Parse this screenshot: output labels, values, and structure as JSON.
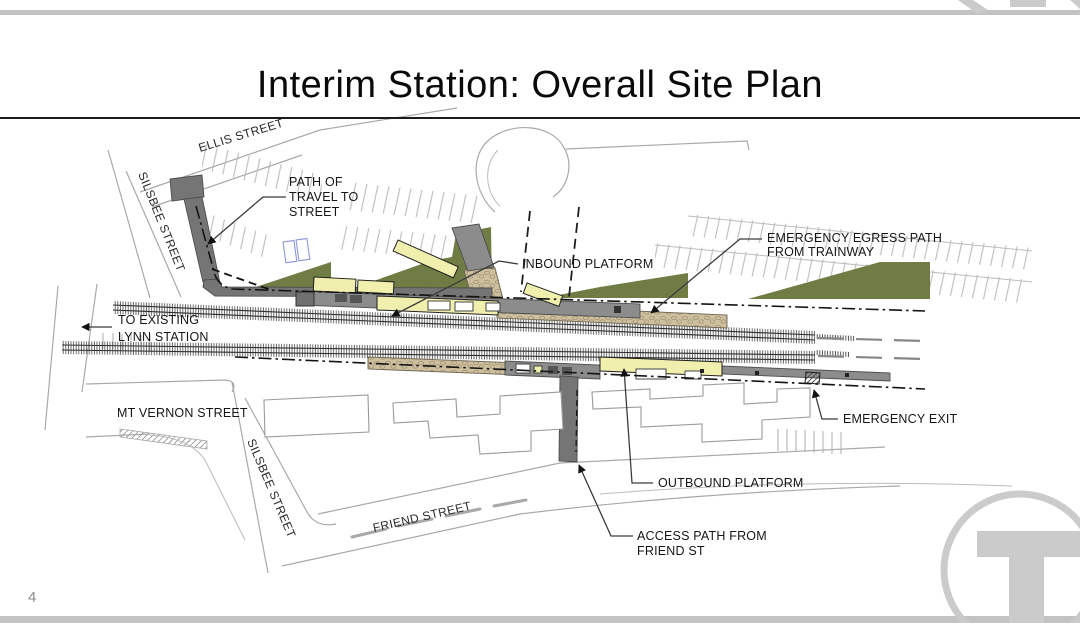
{
  "slide": {
    "title": "Interim Station: Overall Site Plan",
    "page_number": "4"
  },
  "colors": {
    "platform_yellow": "#f1efad",
    "landscape_green": "#6f7d44",
    "path_gray": "#8c8c8c",
    "path_gray_dark": "#757575",
    "egress_tan": "#cec09f",
    "bar_gray": "#c3c3c3",
    "logo_gray": "#cbcbcb",
    "stall_blue": "#8d96d8"
  },
  "street_labels": {
    "ellis": "ELLIS STREET",
    "silsbee_upper": "SILSBEE STREET",
    "mt_vernon": "MT VERNON STREET",
    "silsbee_lower": "SILSBEE STREET",
    "friend": "FRIEND STREET"
  },
  "annotations": {
    "path_of_travel_1": "PATH OF",
    "path_of_travel_2": "TRAVEL TO",
    "path_of_travel_3": "STREET",
    "to_existing_1": "TO EXISTING",
    "to_existing_2": "LYNN STATION",
    "inbound_platform": "INBOUND PLATFORM",
    "emergency_egress_1": "EMERGENCY EGRESS PATH",
    "emergency_egress_2": "FROM TRAINWAY",
    "emergency_exit": "EMERGENCY EXIT",
    "outbound_platform": "OUTBOUND PLATFORM",
    "access_path_1": "ACCESS PATH FROM",
    "access_path_2": "FRIEND ST"
  }
}
